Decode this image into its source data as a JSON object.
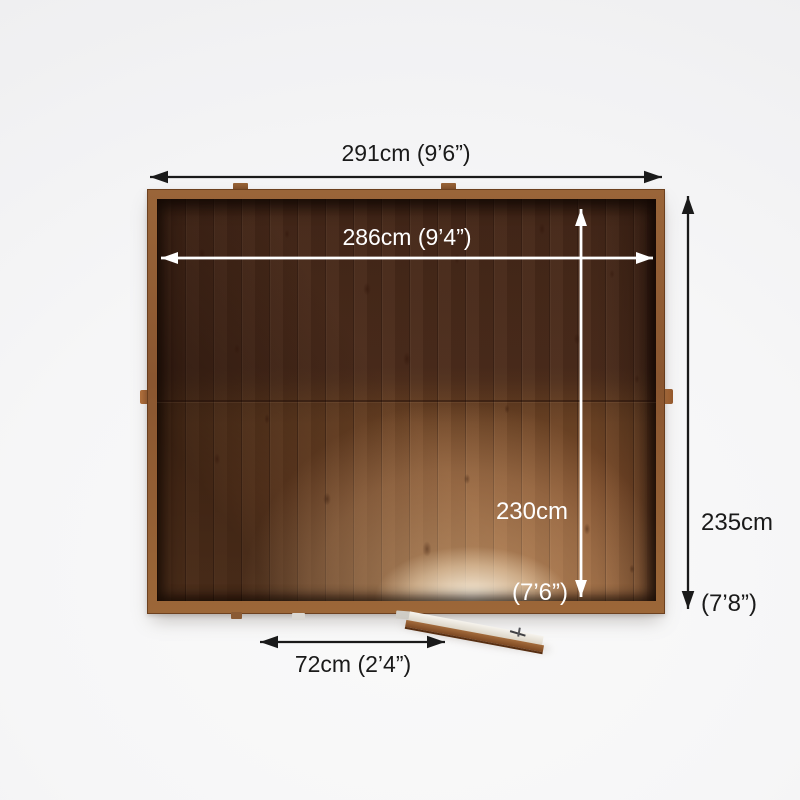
{
  "diagram": {
    "title": "shed-top-view-dimension-diagram",
    "measurements": {
      "outer_width": {
        "label": "291cm (9’6”)"
      },
      "inner_width": {
        "label": "286cm (9’4”)"
      },
      "inner_depth": {
        "metric": "230cm",
        "imperial": "(7’6”)"
      },
      "outer_depth": {
        "metric": "235cm",
        "imperial": "(7’8”)"
      },
      "door_width": {
        "label": "72cm (2’4”)"
      }
    },
    "colors": {
      "background": "#f3f3f4",
      "arrow_dark": "#1a1a1a",
      "arrow_light": "#ffffff",
      "label_dark": "#1a1a1a",
      "label_light": "#ffffff",
      "wood_frame": "#8a5630",
      "wood_interior_dark": "#4f2e1d",
      "wood_interior_light": "#8d5a34",
      "door_wood": "#a46c3c"
    }
  }
}
